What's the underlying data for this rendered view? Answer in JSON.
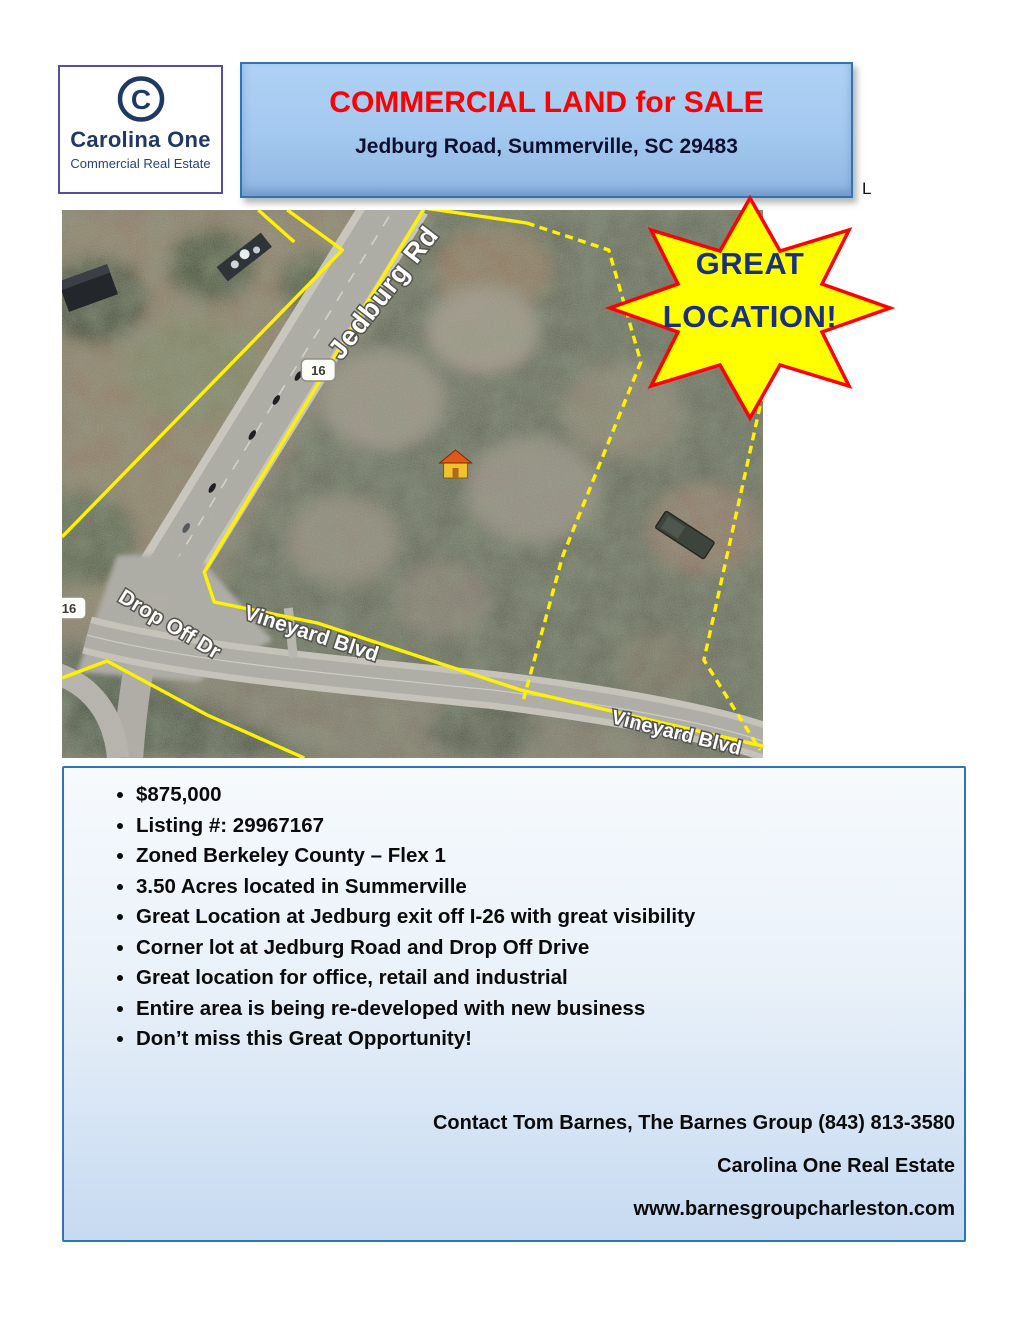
{
  "brand": {
    "name": "Carolina One",
    "tagline": "Commercial Real Estate",
    "mark": "C"
  },
  "header": {
    "title": "COMMERCIAL LAND for SALE",
    "address": "Jedburg Road, Summerville, SC 29483"
  },
  "stray_character": "L",
  "map": {
    "road_labels": {
      "jedburg": "Jedburg Rd",
      "dropoff": "Drop Off Dr",
      "vineyard_upper": "Vineyard Blvd",
      "vineyard_lower": "Vineyard Blvd"
    },
    "route_shield": "16",
    "badge": {
      "line1": "GREAT",
      "line2": "LOCATION!"
    },
    "marker": "house-marker"
  },
  "details": {
    "bullets": [
      "$875,000",
      "Listing #: 29967167",
      "Zoned Berkeley County – Flex 1",
      "3.50 Acres located in Summerville",
      "Great Location at Jedburg exit off I-26 with great visibility",
      "Corner lot at Jedburg Road and Drop Off Drive",
      "Great location for office, retail and industrial",
      "Entire area is being re-developed with new business",
      "Don’t miss this Great Opportunity!"
    ]
  },
  "contact": {
    "lines": [
      "Contact Tom Barnes, The Barnes Group (843) 813-3580",
      "Carolina One Real Estate",
      "www.barnesgroupcharleston.com"
    ]
  },
  "colors": {
    "accent_red": "#FE0000",
    "navy": "#1F3864",
    "box_border_blue": "#2E75B6",
    "star_yellow": "#FFFF00",
    "star_outline": "#FF0000",
    "parcel_line_yellow": "#FFF200"
  }
}
